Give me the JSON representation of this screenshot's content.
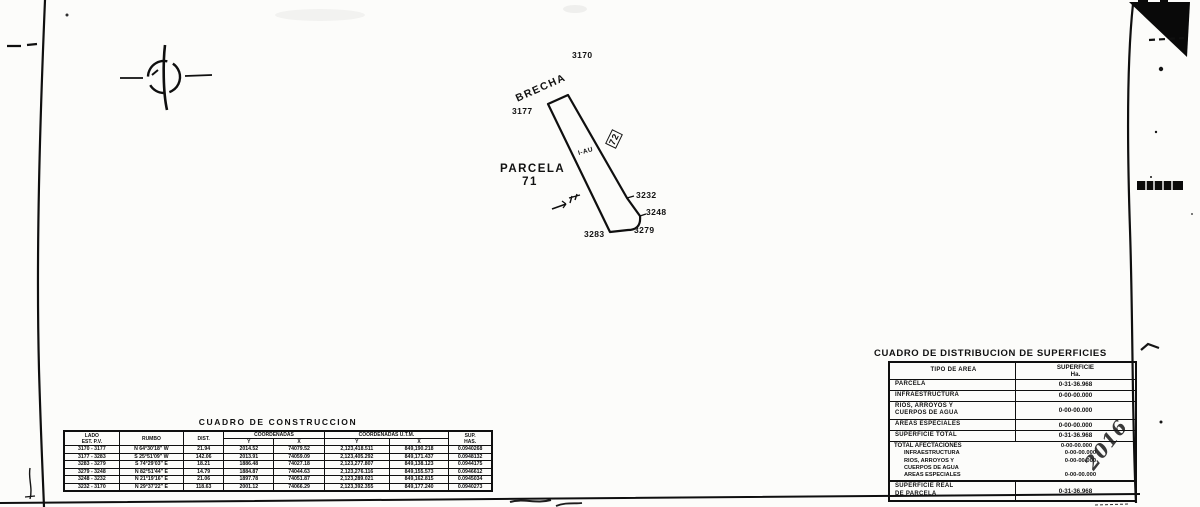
{
  "page": {
    "background": "#fcfcfa",
    "ink": "#141414"
  },
  "drawing": {
    "road_label": "BRECHA",
    "parcel_label_line1": "PARCELA",
    "parcel_label_line2": "71",
    "zone_label": "I-AU",
    "adjacent_label": "72",
    "vertices": [
      {
        "id": "3170"
      },
      {
        "id": "3177"
      },
      {
        "id": "3232"
      },
      {
        "id": "3248"
      },
      {
        "id": "3279"
      },
      {
        "id": "3283"
      }
    ]
  },
  "construction_table": {
    "title": "CUADRO DE CONSTRUCCION",
    "headers": {
      "lado": "LADO",
      "lado_sub": "EST. P.V.",
      "rumbo": "RUMBO",
      "dist": "DIST.",
      "coord_group": "COORDENADAS",
      "coord_y": "Y",
      "coord_x": "X",
      "utm_group": "COORDENADAS U.T.M.",
      "utm_y": "Y",
      "utm_x": "X",
      "sup": "SUP.",
      "sup_sub": "HAS."
    },
    "rows": [
      {
        "lado": "3170 - 3177",
        "rumbo": "N 64°30'18\" W",
        "dist": "21.94",
        "y1": "2014.52",
        "x1": "74079.52",
        "y2": "2,123,418.511",
        "x2": "849,190.218",
        "sup": "0.0940268"
      },
      {
        "lado": "3177 - 3283",
        "rumbo": "S 25°51'09\" W",
        "dist": "142.06",
        "y1": "2013.91",
        "x1": "74059.09",
        "y2": "2,123,405.292",
        "x2": "849,171.437",
        "sup": "0.0948132"
      },
      {
        "lado": "3283 - 3279",
        "rumbo": "S 74°29'03\" E",
        "dist": "18.21",
        "y1": "1886.48",
        "x1": "74027.18",
        "y2": "2,123,277.807",
        "x2": "849,138.123",
        "sup": "0.0944175"
      },
      {
        "lado": "3279 - 3248",
        "rumbo": "N 82°51'44\" E",
        "dist": "14.79",
        "y1": "1884.87",
        "x1": "74044.63",
        "y2": "2,123,276.116",
        "x2": "849,155.573",
        "sup": "0.0946612"
      },
      {
        "lado": "3248 - 3232",
        "rumbo": "N 21°19'16\" E",
        "dist": "21.06",
        "y1": "1897.78",
        "x1": "74051.87",
        "y2": "2,123,289.021",
        "x2": "849,162.815",
        "sup": "0.0945034"
      },
      {
        "lado": "3232 - 3170",
        "rumbo": "N 29°37'22\" E",
        "dist": "118.63",
        "y1": "2001.12",
        "x1": "74066.29",
        "y2": "2,123,392.355",
        "x2": "849,177.240",
        "sup": "0.0940273"
      }
    ]
  },
  "surface_table": {
    "title": "CUADRO DE DISTRIBUCION DE SUPERFICIES",
    "col1_header": "TIPO DE AREA",
    "col2_header_line1": "SUPERFICIE",
    "col2_header_line2": "Ha.",
    "rows": {
      "parcela": {
        "label": "PARCELA",
        "value": "0-31-36.968"
      },
      "infra": {
        "label": "INFRAESTRUCTURA",
        "value": "0-00-00.000"
      },
      "rios": {
        "label": "RIOS, ARROYOS Y",
        "label2": "CUERPOS DE AGUA",
        "value": "0-00-00.000"
      },
      "areas": {
        "label": "AREAS ESPECIALES",
        "value": "0-00-00.000"
      },
      "sup_total": {
        "label": "SUPERFICIE TOTAL",
        "value": "0-31-36.968"
      },
      "afectaciones": {
        "label": "TOTAL AFECTACIONES",
        "value": "0-00-00.000"
      },
      "afect_infra": {
        "label": "INFRAESTRUCTURA",
        "value": "0-00-00.000"
      },
      "afect_rios": {
        "label": "RIOS, ARROYOS Y",
        "label2": "CUERPOS DE AGUA",
        "value": "0-00-00.000"
      },
      "afect_areas": {
        "label": "AREAS ESPECIALES",
        "value": "0-00-00.000"
      },
      "sup_real": {
        "label": "SUPERFICIE REAL",
        "label2": "DE PARCELA",
        "value": "0-31-36.968"
      }
    },
    "handwritten_note": "2016"
  }
}
